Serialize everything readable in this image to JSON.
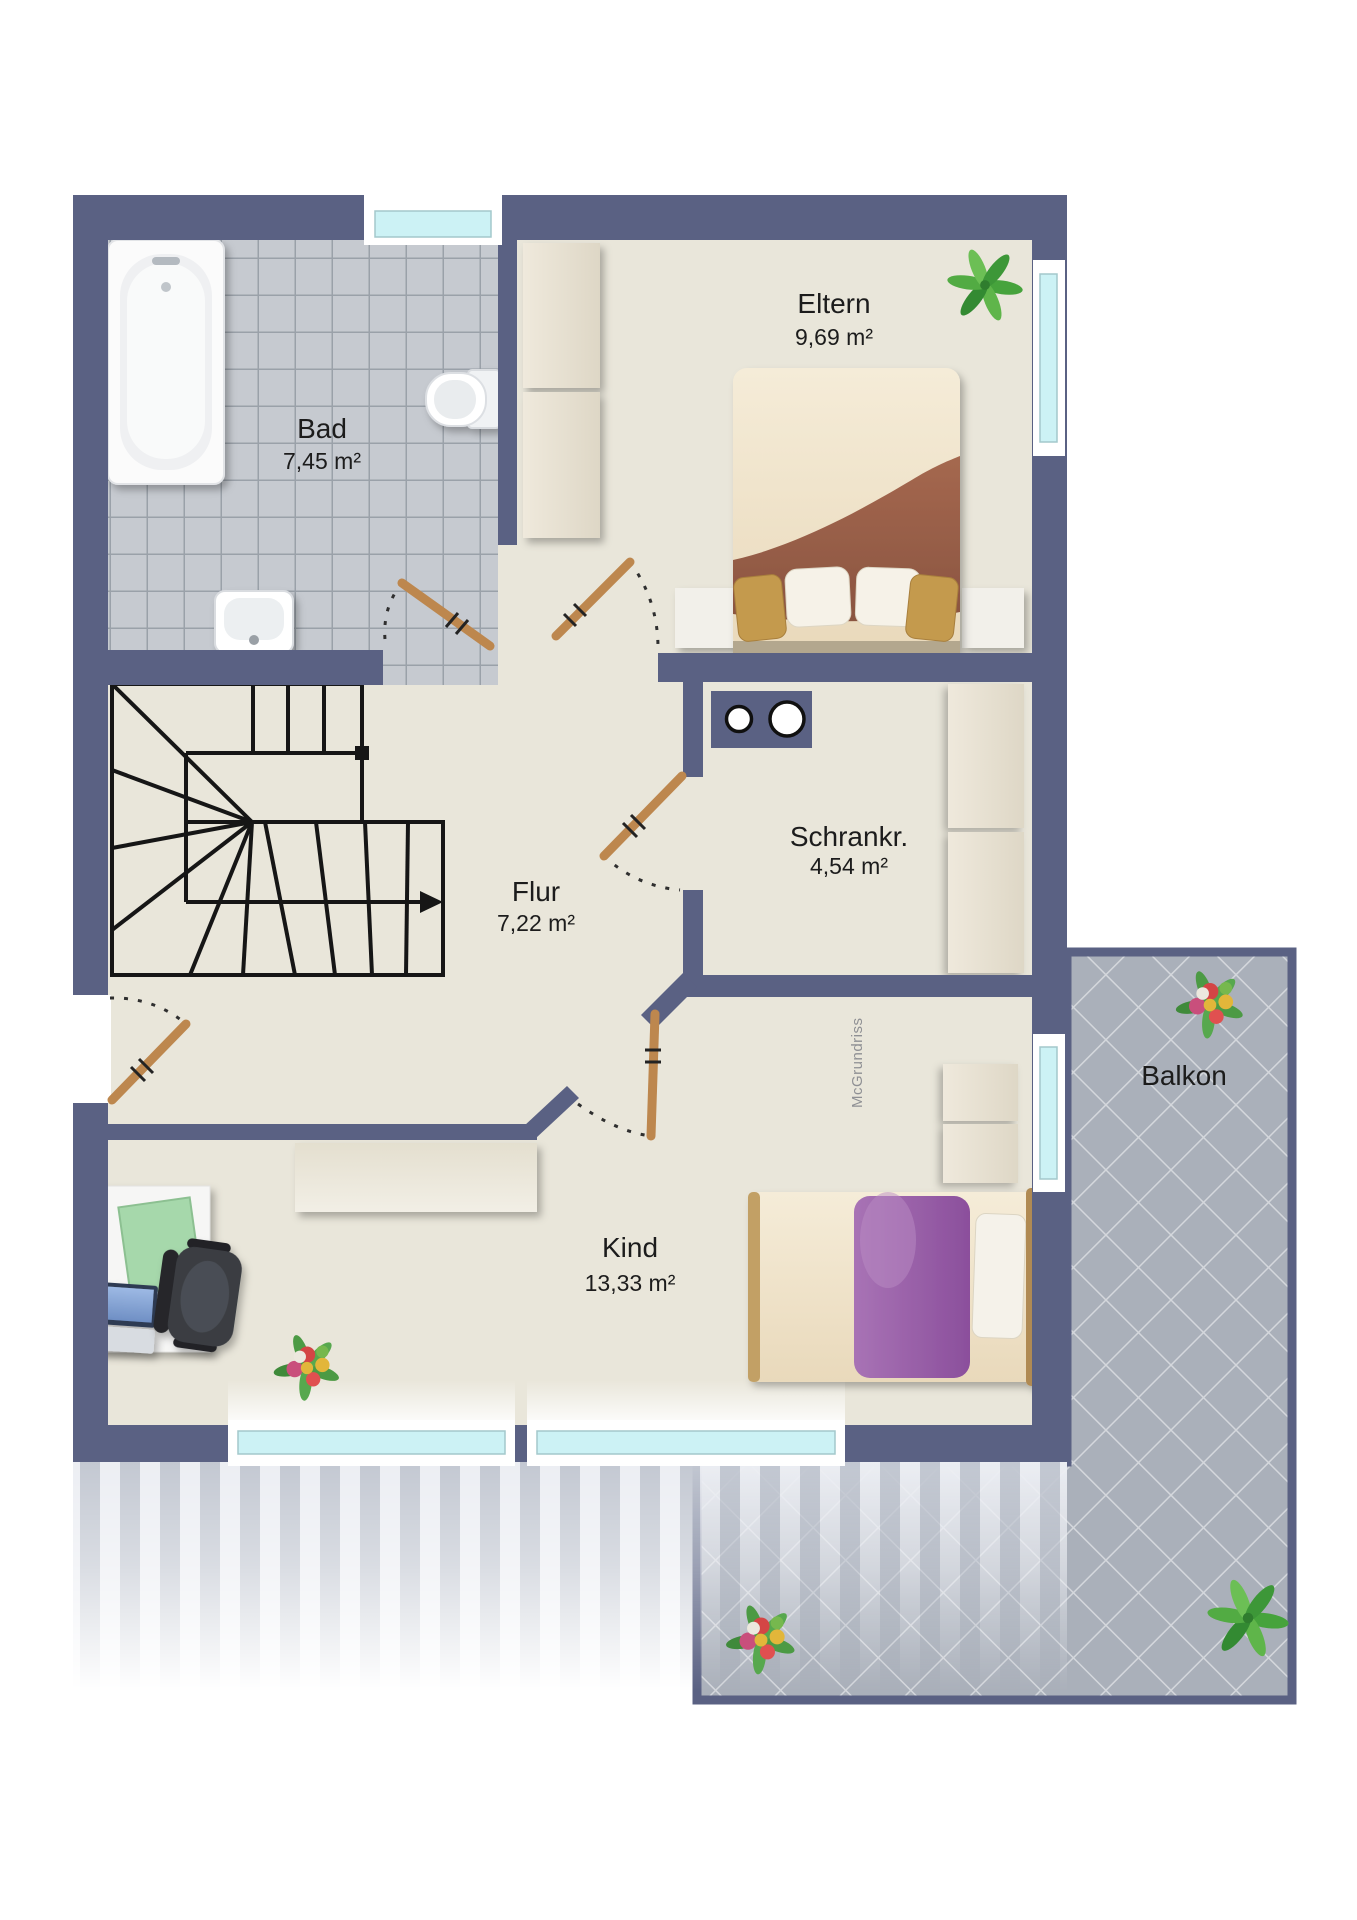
{
  "rooms": {
    "bad": {
      "label": "Bad",
      "area": "7,45 m²"
    },
    "eltern": {
      "label": "Eltern",
      "area": "9,69 m²"
    },
    "flur": {
      "label": "Flur",
      "area": "7,22 m²"
    },
    "schrankraum": {
      "label": "Schrankr.",
      "area": "4,54 m²"
    },
    "kind": {
      "label": "Kind",
      "area": "13,33 m²"
    },
    "balkon": {
      "label": "Balkon"
    }
  },
  "watermark": "McGrundriss",
  "colors": {
    "wall": "#5a6183",
    "floor": "#e9e6da",
    "bad_tile": "#c6cad0",
    "bad_grout": "#9aa1a9",
    "balcony_tile": "#aab0ba",
    "balcony_grout": "#d4d7dc",
    "glass": "#ccf2f5",
    "frame": "#ffffff",
    "door": "#bd874e",
    "line": "#161616",
    "label": "#1c1c1c",
    "watermark": "#8f9094",
    "stripe_a": "#c3c8d2",
    "stripe_b": "#eceef3"
  }
}
